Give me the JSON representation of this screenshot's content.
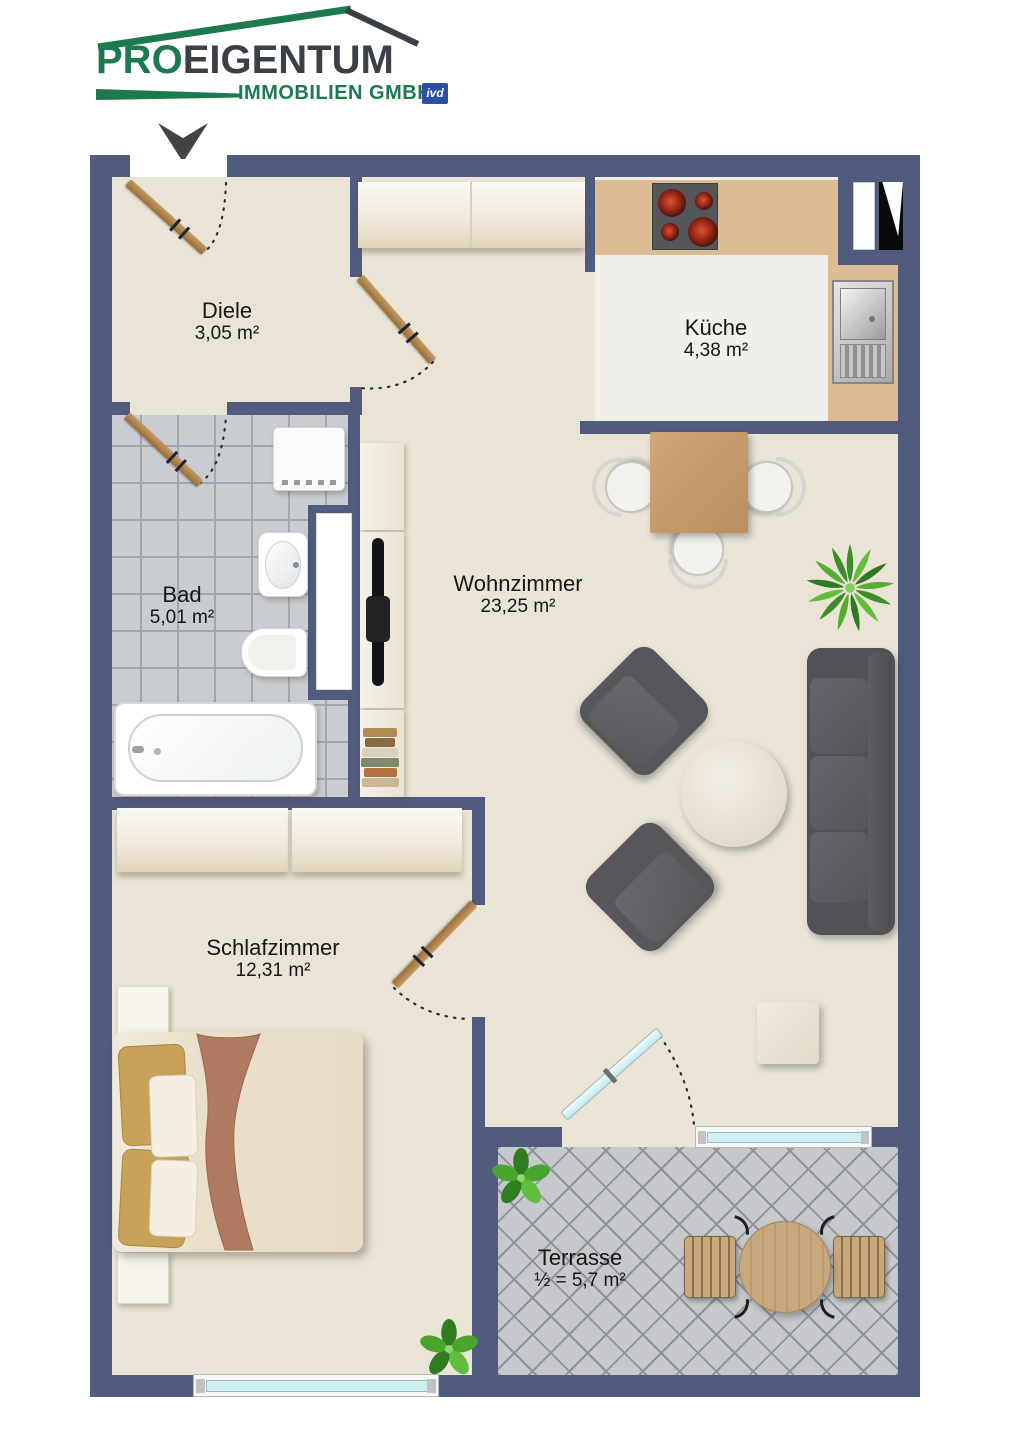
{
  "logo": {
    "brand_pro": "PRO",
    "brand_rest": "EIGENTUM",
    "subtitle": "IMMOBILIEN GMBH",
    "badge": "ivd"
  },
  "rooms": {
    "diele": {
      "name": "Diele",
      "area": "3,05 m²"
    },
    "kueche": {
      "name": "Küche",
      "area": "4,38 m²"
    },
    "bad": {
      "name": "Bad",
      "area": "5,01 m²"
    },
    "wohnzimmer": {
      "name": "Wohnzimmer",
      "area": "23,25 m²"
    },
    "schlafzimmer": {
      "name": "Schlafzimmer",
      "area": "12,31 m²"
    },
    "terrasse": {
      "name": "Terrasse",
      "area": "½ = 5,7 m²"
    }
  },
  "colors": {
    "wall": "#505b7d",
    "brand_green": "#1c7a4e",
    "brand_gray": "#3b4046",
    "ivd_blue": "#2d4fa1",
    "floor_beige": "#e9e4d6",
    "kitchen_floor": "#f1efe9",
    "kitchen_counter": "#dcbb95",
    "bath_tile": "#c9ccd1",
    "terrace_tile": "#c6c8cb",
    "window_glass": "#cdeff3",
    "door_wood": "#b07c44",
    "furniture_gray": "#57575b"
  }
}
